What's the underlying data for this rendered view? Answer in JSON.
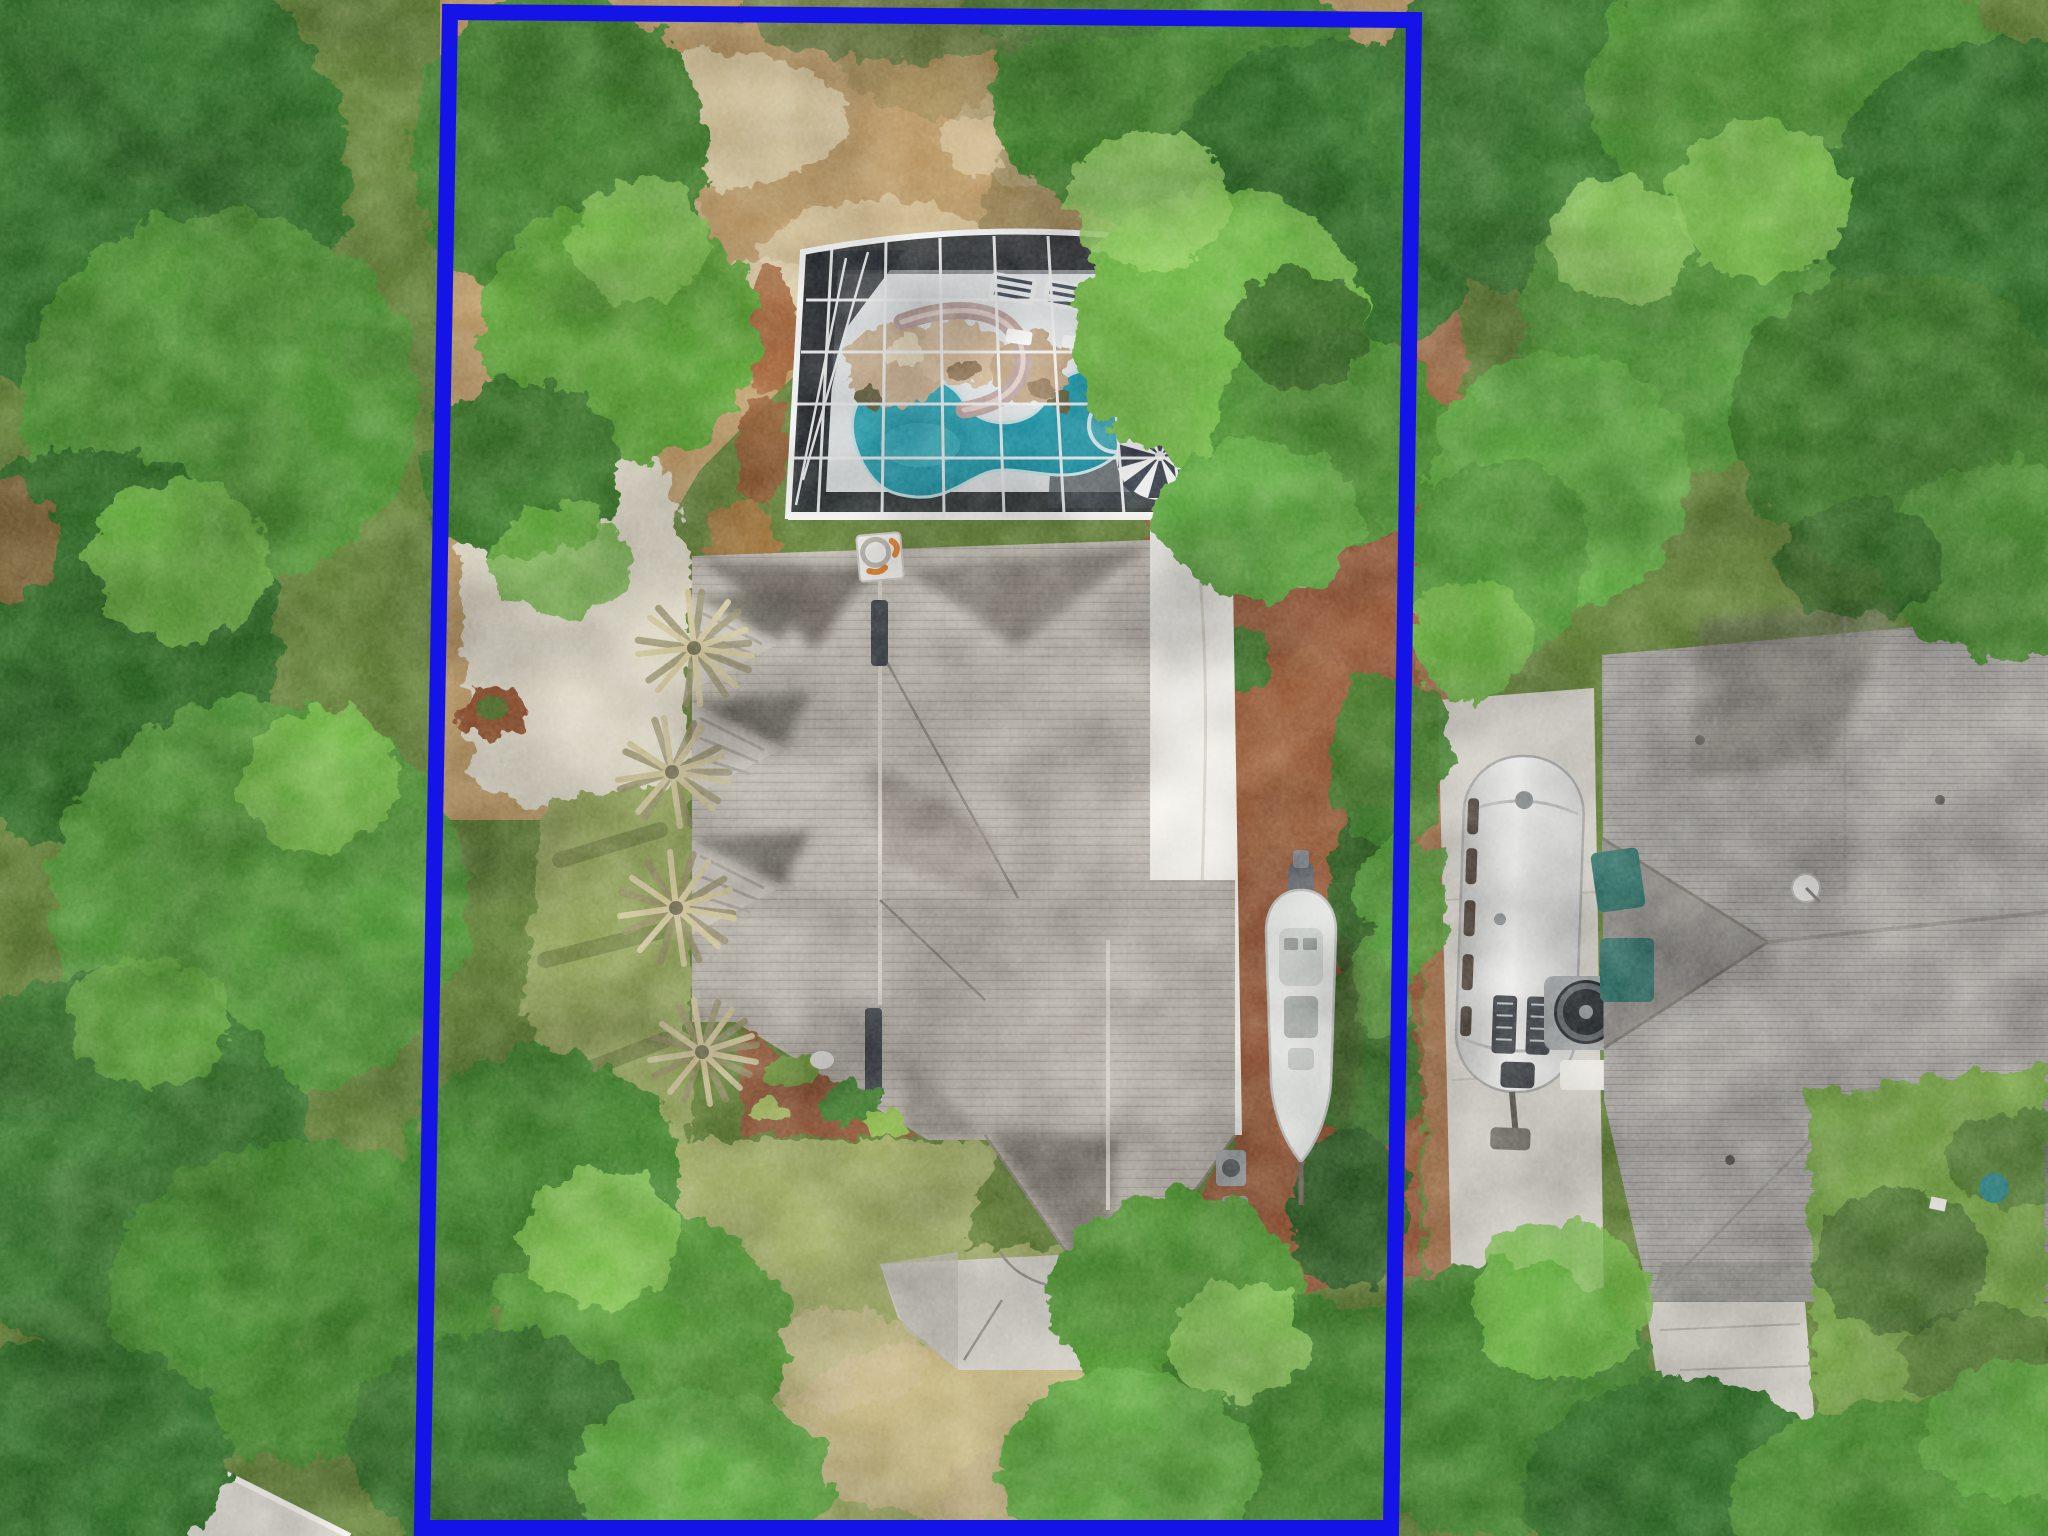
{
  "image": {
    "kind": "aerial-drone-photograph",
    "description": "Overhead aerial view of a residential lot outlined with a blue property boundary. Inside the lot: a gray-shingled house, screened pool enclosure with rock waterfall and slide, striped patio umbrella, palm trees, red mulch side yard with a white boat on a trailer, cracked concrete driveway pad, lawn and mature trees. Right of the lot: a silver travel trailer on a concrete pad, an AC fan unit and a neighboring gray hip roof with satellite dish, patio and lawn.",
    "width_px": 2048,
    "height_px": 1536
  },
  "palette": {
    "boundary_blue": "#1414e6",
    "pool_teal": "#2aa7b8",
    "pool_deep": "#157f94",
    "deck_white": "#dde1e2",
    "screen_dark": "#282c31",
    "frame_white": "#eceeee",
    "roof_light": "#b7b1a8",
    "roof_shadow": "#57534c",
    "flat_roof_white": "#f2f0ea",
    "mulch_red": "#8f5234",
    "dirt_tan": "#b5925f",
    "sand_light": "#e3d6ae",
    "gravel_light": "#d8d2c0",
    "grass_olive": "#8a9b52",
    "lawn_green": "#6e9c3f",
    "tree_dark": "#2f6b26",
    "tree_mid": "#478a2e",
    "tree_light": "#6ab33f",
    "neighbor_roof_gray": "#a09d99",
    "concrete_gray": "#cfccc4",
    "airstream_silver": "#e4e4e2",
    "boat_white": "#e8eae7",
    "umbrella_dark": "#2e3440",
    "slide_mauve": "#b49a96",
    "rock_tan": "#c2a888",
    "chimney_orange": "#e07a2a",
    "hedge_green": "#2e5a22"
  },
  "scene": {
    "objects": [
      {
        "name": "property-boundary",
        "desc": "thick blue rectangle outlining the lot"
      },
      {
        "name": "pool-enclosure",
        "desc": "black screen cage with white aluminum frame grid"
      },
      {
        "name": "swimming-pool",
        "desc": "freeform teal pool with attached round spa"
      },
      {
        "name": "rock-waterfall",
        "desc": "tan boulder waterfall feature beside pool"
      },
      {
        "name": "water-slide",
        "desc": "curved mauve slide into the pool"
      },
      {
        "name": "lounge-chairs",
        "desc": "two striped loungers on pool deck"
      },
      {
        "name": "patio-umbrella",
        "desc": "black and white striped umbrella"
      },
      {
        "name": "house-roof",
        "desc": "light gray shingle hip roof with left gables and ridge vents"
      },
      {
        "name": "chimney-cap",
        "desc": "white rooftop box with orange accents"
      },
      {
        "name": "flat-roof-strip",
        "desc": "white flat roof along right side of house"
      },
      {
        "name": "palm-trees",
        "desc": "row of palms along left wall of house"
      },
      {
        "name": "garden-bed",
        "desc": "red mulch planting bed with shrubs"
      },
      {
        "name": "driveway-pad",
        "desc": "cracked concrete pad at house front"
      },
      {
        "name": "boat",
        "desc": "white center-console boat on trailer over red mulch"
      },
      {
        "name": "mulch-side-yard",
        "desc": "red-brown mulch strip with hedge"
      },
      {
        "name": "paver-walkway",
        "desc": "gray paver path beside enclosure"
      },
      {
        "name": "airstream-trailer",
        "desc": "silver rounded travel trailer on concrete pad"
      },
      {
        "name": "ac-fan-unit",
        "desc": "round condenser fan beside neighbor house"
      },
      {
        "name": "neighbor-roof",
        "desc": "large gray hip roof with satellite dish"
      },
      {
        "name": "neighbor-lawn",
        "desc": "bright green lawn with tree shadows"
      },
      {
        "name": "trees",
        "desc": "dense green tree canopies surrounding the lot"
      },
      {
        "name": "street-edge",
        "desc": "light concrete road corner at bottom left"
      }
    ]
  }
}
